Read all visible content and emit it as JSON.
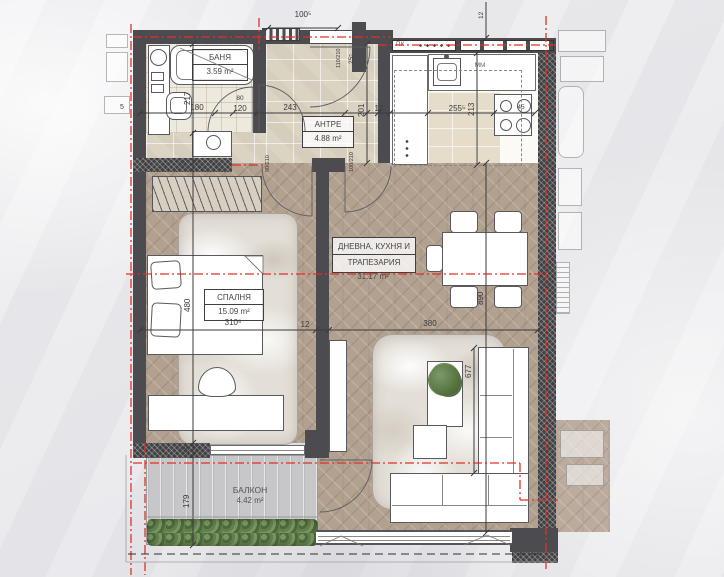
{
  "rooms": {
    "bathroom": {
      "name": "БАНЯ",
      "area": "3.59 m²"
    },
    "hallway": {
      "name": "АНТРЕ",
      "area": "4.88 m²"
    },
    "living": {
      "name_line1": "ДНЕВНА, КУХНЯ И",
      "name_line2": "ТРАПЕЗАРИЯ",
      "area": "31.17 m²"
    },
    "bedroom": {
      "name": "СПАЛНЯ",
      "area": "15.09 m²"
    },
    "balcony": {
      "name": "БАЛКОН",
      "area": "4.42 m²"
    }
  },
  "annotations": {
    "upper_cabinet": "ПК",
    "microwave": "ММ"
  },
  "dimensions": {
    "entry_opening": "100⁵",
    "wall_top_12": "12",
    "hall_corner_25": "25⁵",
    "hall_door": "110/210",
    "bath_width": "180",
    "bath_depth": "217",
    "bath_door_niche": "120",
    "bath_door": "80",
    "hall_width": "243",
    "hall_depth": "201",
    "wall_12": "12",
    "kitchen_width": "255⁵",
    "kitchen_depth": "213",
    "stove_gap": "45",
    "bedroom_depth": "480",
    "bedroom_width": "310⁵",
    "partition_12": "12",
    "living_width": "380",
    "living_depth": "890",
    "sofa_length": "677",
    "balcony_depth": "179",
    "balcony_wall_25": "25",
    "bedroom_door": "90/210",
    "living_door": "100/210",
    "left_edge_5": "5"
  },
  "colors": {
    "wall": "#4c4c50",
    "red_centerline": "#dd3326",
    "wood_floor": "#b3a190",
    "stone_tile": "#dcd4c3",
    "deck": "#c7c7c9",
    "plant": "#5d7a52"
  }
}
